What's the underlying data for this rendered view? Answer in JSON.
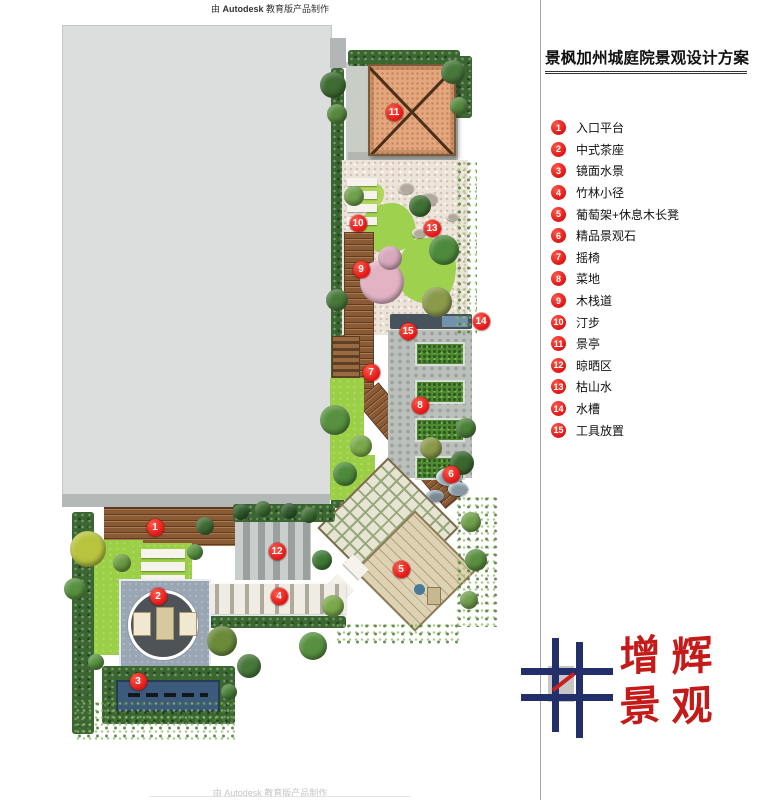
{
  "watermark": {
    "top": "由 Autodesk 教育版产品制作",
    "top_brand": "Autodesk",
    "top_prefix": "由 ",
    "top_suffix": " 教育版产品制作",
    "bottom": "由 Autodesk 教育版产品制作"
  },
  "panel": {
    "title": "景枫加州城庭院景观设计方案",
    "legend": [
      {
        "num": "1",
        "label": "入口平台"
      },
      {
        "num": "2",
        "label": "中式茶座"
      },
      {
        "num": "3",
        "label": "镜面水景"
      },
      {
        "num": "4",
        "label": "竹林小径"
      },
      {
        "num": "5",
        "label": "葡萄架+休息木长凳"
      },
      {
        "num": "6",
        "label": "精品景观石"
      },
      {
        "num": "7",
        "label": "摇椅"
      },
      {
        "num": "8",
        "label": "菜地"
      },
      {
        "num": "9",
        "label": "木栈道"
      },
      {
        "num": "10",
        "label": "汀步"
      },
      {
        "num": "11",
        "label": "景亭"
      },
      {
        "num": "12",
        "label": "晾晒区"
      },
      {
        "num": "13",
        "label": "枯山水"
      },
      {
        "num": "14",
        "label": "水槽"
      },
      {
        "num": "15",
        "label": "工具放置"
      }
    ]
  },
  "logo": {
    "name_chars": [
      "增",
      "辉"
    ],
    "type_chars": [
      "景",
      "观"
    ]
  },
  "plan": {
    "markers": [
      {
        "num": "1",
        "x": 155,
        "y": 527
      },
      {
        "num": "2",
        "x": 158,
        "y": 596
      },
      {
        "num": "3",
        "x": 138,
        "y": 681
      },
      {
        "num": "4",
        "x": 279,
        "y": 596
      },
      {
        "num": "5",
        "x": 401,
        "y": 569
      },
      {
        "num": "6",
        "x": 451,
        "y": 474
      },
      {
        "num": "7",
        "x": 371,
        "y": 372
      },
      {
        "num": "8",
        "x": 420,
        "y": 405
      },
      {
        "num": "9",
        "x": 361,
        "y": 269
      },
      {
        "num": "10",
        "x": 358,
        "y": 223
      },
      {
        "num": "11",
        "x": 394,
        "y": 112
      },
      {
        "num": "12",
        "x": 277,
        "y": 551
      },
      {
        "num": "13",
        "x": 432,
        "y": 228
      },
      {
        "num": "14",
        "x": 481,
        "y": 321
      },
      {
        "num": "15",
        "x": 408,
        "y": 331
      }
    ]
  },
  "colors": {
    "marker_red": "#e01414",
    "logo_navy": "#232f6b",
    "logo_red": "#c41a1a",
    "building_gray": "#dcdede",
    "pool_blue": "#3c5a7c",
    "pavilion_roof": "#e3a67d"
  }
}
